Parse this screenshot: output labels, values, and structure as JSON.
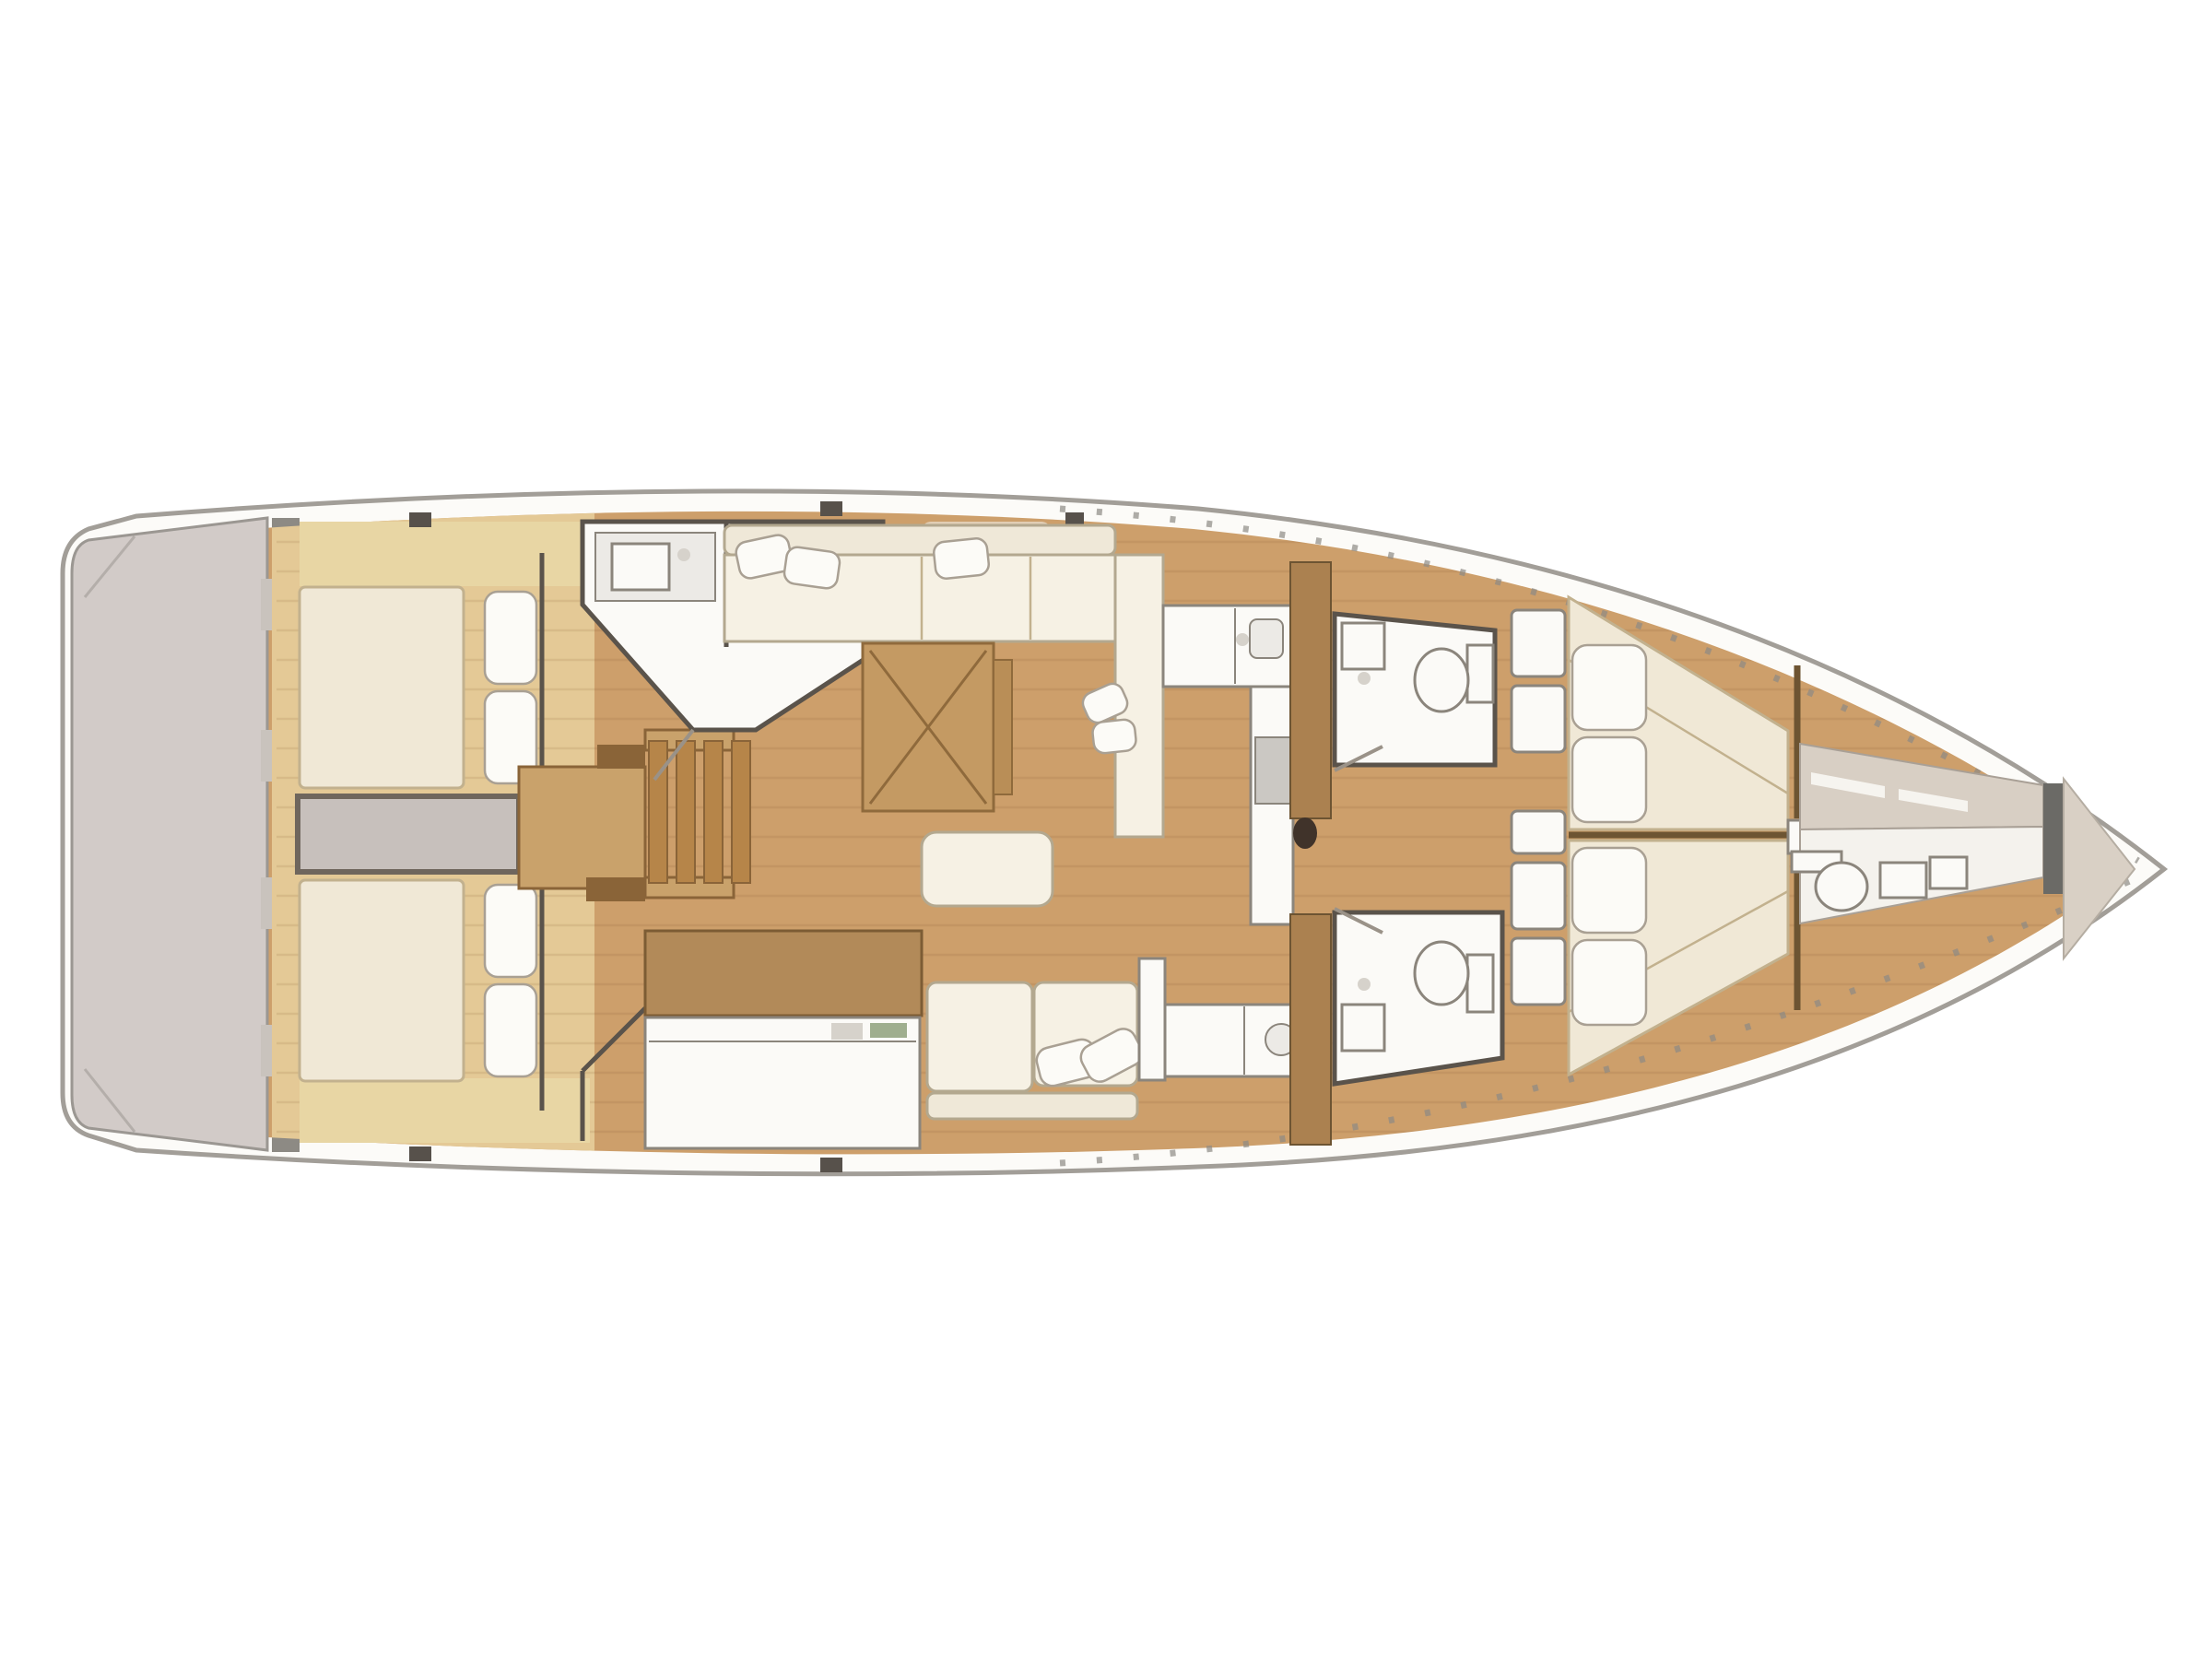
{
  "figure": {
    "kind": "boat-interior-floor-plan",
    "view": "top-down"
  },
  "palette": {
    "background": "#ffffff",
    "hull_outline": "#a29e98",
    "hull_band": "#fcfbf8",
    "deck_wood": "#cd9f6b",
    "aft_wood": "#e4c996",
    "plank_line": "rgba(120,84,40,0.12)",
    "platform": "#d2cbc8",
    "platform_edge": "#9b9792",
    "transom_wall": "#8d8a84",
    "transom_dark": "#6f6b66",
    "transom_notch": "#c9c3bd",
    "pale_wood": "#e8d6a4",
    "walkway": "#c7c0bc",
    "walkway_border": "#6f665d",
    "berth": "#f0e8d6",
    "berth_edge": "#c2b18e",
    "pillow": "#fcfbf7",
    "pillow_edge": "#a9a093",
    "cushion": "#f6f1e4",
    "cushion_edge": "#b3a88f",
    "sofa_back": "#efe8d8",
    "fixture_white": "#fbfaf7",
    "fixture_edge": "#8b857c",
    "room_wall": "#5a534b",
    "counter_gray": "#eceae6",
    "stove_gray": "#cbc8c3",
    "table_wood": "#c49a63",
    "table_edge": "#8f6a3c",
    "table_leaf": "#b98e57",
    "stairs_base": "#c9a26b",
    "stairs_slat": "#b68549",
    "stairs_dark": "#8a6438",
    "nav_cabinet": "#b28a59",
    "nav_edge": "#7c5c34",
    "accent_green": "#9fae8e",
    "instrument_gray": "#d6d2cb",
    "bulkhead_wood": "#ab8150",
    "bulkhead_edge": "#6d5432",
    "mast": "#40332a",
    "crew_beige": "#d8cfc4",
    "crew_beige_edge": "#a9a096",
    "crew_white": "#f4f2ed",
    "bow_dark": "#6b6a66",
    "bow_tip": "#d9d0c5",
    "bow_tip_edge": "#b5ada2",
    "deck_fitting": "#57514b",
    "stanchion": "#8d8a84",
    "hatch": "#e9e2d4",
    "door_leaf": "#9a9288"
  },
  "regions": {
    "swim_platform": "fold-down swim platform",
    "aft_cabin_port": "aft double cabin port",
    "aft_cabin_starboard": "aft double cabin starboard",
    "engine_walkway": "engine compartment walkway",
    "companionway": "companionway steps",
    "day_head": "aft head with sink and toilet",
    "salon": "salon with L-sofa and folding table",
    "nav_station": "chart table",
    "galley_port": "galley port side",
    "galley_starboard": "galley starboard side",
    "head_forward_port": "forward head port",
    "head_forward_starboard": "forward head starboard",
    "owner_cabin": "forward owner cabin V-berth",
    "crew_compartment": "bow crew compartment",
    "bow_locker": "anchor locker"
  }
}
